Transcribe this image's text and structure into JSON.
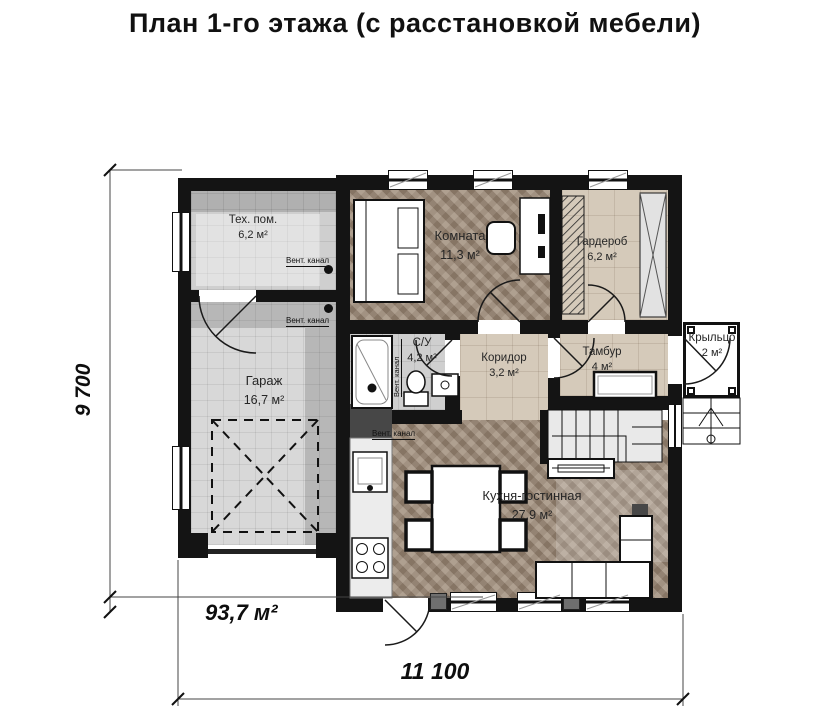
{
  "title": "План 1-го этажа (с расстановкой мебели)",
  "rooms": [
    {
      "name": "Тех. пом.",
      "area": "6,2 м²"
    },
    {
      "name": "Комната",
      "area": "11,3 м²"
    },
    {
      "name": "Гардероб",
      "area": "6,2 м²"
    },
    {
      "name": "Гараж",
      "area": "16,7 м²"
    },
    {
      "name": "С/У",
      "area": "4,2 м²"
    },
    {
      "name": "Коридор",
      "area": "3,2 м²"
    },
    {
      "name": "Тамбур",
      "area": "4 м²"
    },
    {
      "name": "Крыльцо",
      "area": "2 м²"
    },
    {
      "name": "Кухня-гостинная",
      "area": "27,9 м²"
    }
  ],
  "vent_labels": {
    "tech": "Вент. канал",
    "garage": "Вент. канал",
    "bathroom": "Вент. канал",
    "kitchen": "Вент. канал"
  },
  "dimensions": {
    "side": "9 700",
    "bottom": "11 100",
    "total_area": "93,7 м²"
  },
  "colors": {
    "wall": "#141414",
    "wood_floor": "#a2907e",
    "beige_tile": "#d5caba",
    "gray_tile": "#cfcfcf"
  }
}
